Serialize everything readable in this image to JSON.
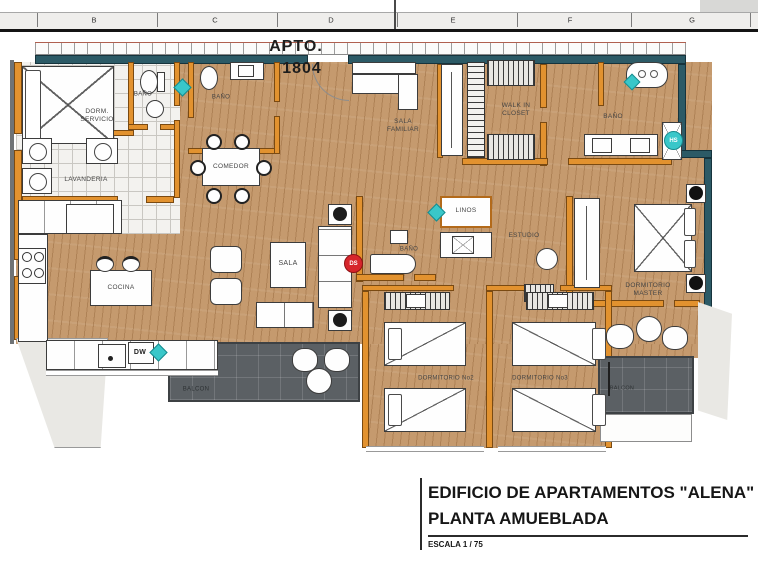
{
  "ruler": {
    "letters": [
      "B",
      "C",
      "D",
      "E",
      "F",
      "G"
    ]
  },
  "plan": {
    "apto_label": "APTO.",
    "apto_number": "1804",
    "rooms": {
      "dorm_servicio": "DORM.\nSERVICIO",
      "bano_servicio": "BAÑO",
      "lavanderia": "LAVANDERIA",
      "bano_social": "BAÑO",
      "comedor": "COMEDOR",
      "sala_familiar": "SALA\nFAMILIAR",
      "walk_in_closet": "WALK IN\nCLOSET",
      "bano_master": "BAÑO",
      "linos": "LINOS",
      "estudio": "ESTUDIO",
      "bano_central": "BAÑO",
      "sala": "SALA",
      "cocina": "COCINA",
      "dw": "DW",
      "dormitorio_master": "DORMITORIO\nMASTER",
      "dormitorio_no2": "DORMITORIO No2",
      "dormitorio_no3": "DORMITORIO No3",
      "balcon_left": "BALCON",
      "balcon_right": "BALCON"
    },
    "markers": {
      "ds": "DS",
      "hs": "HS"
    }
  },
  "title_block": {
    "building": "EDIFICIO  DE APARTAMENTOS \"ALENA\"",
    "plan_type": "PLANTA AMUEBLADA",
    "scale": "ESCALA 1 / 75"
  },
  "colors": {
    "wood_floor": "#c59a6e",
    "interior_wall": "#e2922f",
    "exterior_wall": "#2c5a66",
    "balcony_tile": "#5b6064",
    "marker_teal": "#39c7c9",
    "marker_red": "#d6252b"
  }
}
